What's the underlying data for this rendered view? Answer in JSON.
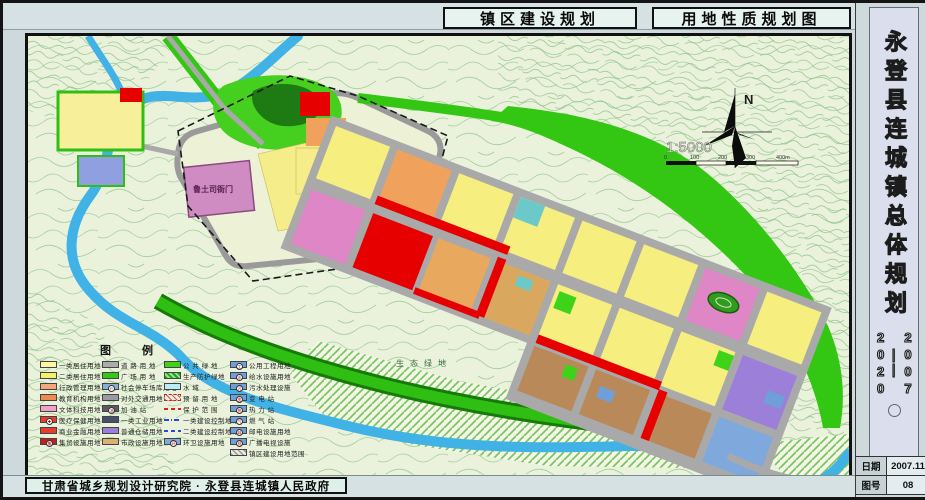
{
  "header": {
    "left_title": "镇区建设规划",
    "right_title": "用地性质规划图"
  },
  "side_panel": {
    "title": "永登县连城镇总体规划",
    "years_start": "2007",
    "years_dash": "——",
    "years_end": "2020",
    "date_label": "日期",
    "date_value": "2007.11",
    "sheet_label": "图号",
    "sheet_value": "08"
  },
  "footer": {
    "credit": "甘肃省城乡规划设计研究院 · 永登县连城镇人民政府"
  },
  "map": {
    "north_label": "N",
    "scale_text": "1:5000",
    "scale_ticks": [
      "0",
      "100",
      "200",
      "300",
      "400m"
    ],
    "labels": {
      "eco_green": "生态绿地",
      "heritage_site": "鲁土司衙门"
    },
    "colors": {
      "residential": "#f6ee7e",
      "commercial_red": "#e60000",
      "culture_pink": "#df86c6",
      "education_orange": "#f0a25c",
      "warehouse_purple": "#9b7fd9",
      "utility_blue": "#6f9fd8",
      "green_space": "#33c714",
      "water": "#41b2e6",
      "road_gray": "#a9a9a9"
    }
  },
  "legend": {
    "title": "图 例",
    "columns": [
      [
        {
          "label": "一类居住用地",
          "color": "#fdf5a2",
          "style": ""
        },
        {
          "label": "二类居住用地",
          "color": "#f7ee6a",
          "style": ""
        },
        {
          "label": "行政管理用地",
          "color": "#f4a77c",
          "style": ""
        },
        {
          "label": "教育机构用地",
          "color": "#ef8a50",
          "style": ""
        },
        {
          "label": "文体科技用地",
          "color": "#f2a0c8",
          "style": ""
        },
        {
          "label": "医疗保健用地",
          "color": "#e93c30",
          "style": "",
          "symbol": "✚"
        },
        {
          "label": "商业金融用地",
          "color": "#e93c30",
          "style": ""
        },
        {
          "label": "集贸设施用地",
          "color": "#c2201a",
          "style": "",
          "symbol": "集"
        }
      ],
      [
        {
          "label": "道 路 用 地",
          "color": "#ababab",
          "style": ""
        },
        {
          "label": "广 场 用 地",
          "color": "#35c818",
          "style": ""
        },
        {
          "label": "社会停车场库用地",
          "color": "#86aed6",
          "style": "",
          "symbol": "P"
        },
        {
          "label": "对外交通用地",
          "color": "#9a9aa6",
          "style": ""
        },
        {
          "label": "加  油  站",
          "color": "#5a5a64",
          "style": "",
          "symbol": "油"
        },
        {
          "label": "一类工业用地",
          "color": "#46506e",
          "style": ""
        },
        {
          "label": "普通仓储用地",
          "color": "#9b7fd9",
          "style": ""
        },
        {
          "label": "市政设施用地",
          "color": "#d9b273",
          "style": ""
        }
      ],
      [
        {
          "label": "公 共 绿 地",
          "color": "#3ed218",
          "style": ""
        },
        {
          "label": "生产防护绿地",
          "color": "#2fae3c",
          "style": "hatch-green"
        },
        {
          "label": "水       域",
          "color": "#b9eef8",
          "style": ""
        },
        {
          "label": "预 留 用 地",
          "color": "#f6f2df",
          "style": "hatch-red"
        },
        {
          "label": "保 护 范 围",
          "color": "",
          "style": "dash-red"
        },
        {
          "label": "一类建设控制地带",
          "color": "",
          "style": "dashdot-blue"
        },
        {
          "label": "二类建设控制地带",
          "color": "",
          "style": "dash-blue"
        },
        {
          "label": "环卫设施用地",
          "color": "#7fa8dd",
          "style": "",
          "symbol": "环"
        }
      ],
      [
        {
          "label": "公用工程用地",
          "color": "#6f9fd8",
          "style": "",
          "symbol": "工"
        },
        {
          "label": "给水设施用地",
          "color": "#6f9fd8",
          "style": "",
          "symbol": "水"
        },
        {
          "label": "污水处理设施",
          "color": "#6f9fd8",
          "style": "",
          "symbol": "污"
        },
        {
          "label": "变  电  站",
          "color": "#6f9fd8",
          "style": "",
          "symbol": "变"
        },
        {
          "label": "热  力  站",
          "color": "#6f9fd8",
          "style": "",
          "symbol": "热"
        },
        {
          "label": "燃  气  站",
          "color": "#6f9fd8",
          "style": "",
          "symbol": "气"
        },
        {
          "label": "邮电设施用地",
          "color": "#6f9fd8",
          "style": "",
          "symbol": "邮"
        },
        {
          "label": "广播电视设施",
          "color": "#6f9fd8",
          "style": "",
          "symbol": "视"
        },
        {
          "label": "镇区建设用地范围",
          "color": "#cfcfc4",
          "style": "hatch-gray"
        }
      ]
    ]
  }
}
